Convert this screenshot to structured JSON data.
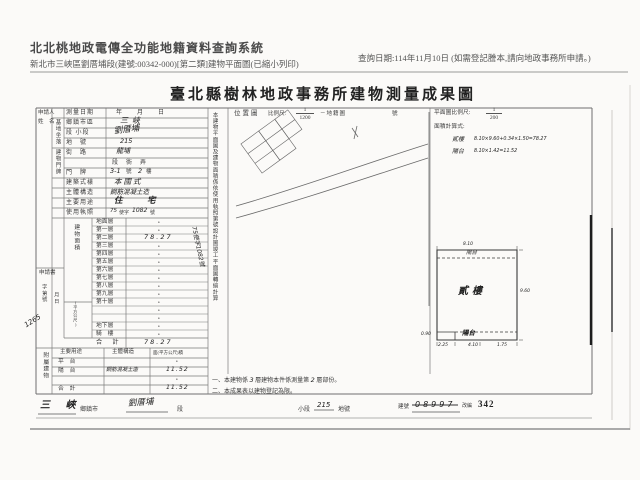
{
  "header": {
    "system_title": "北北桃地政電傳全功能地籍資料查詢系統",
    "subtitle": "新北市三峽區劉厝埔段(建號:00342-000)[第二類]建物平面圖(已縮小列印)",
    "query_date": "查詢日期:114年11月10日 (如需登記謄本,請向地政事務所申請。)"
  },
  "doc": {
    "title": "臺北縣樹林地政事務所建物測量成果圖",
    "form": {
      "applicant_line1": "申請人",
      "applicant_line2": "姓　名",
      "survey": {
        "label": "測量日期",
        "value": "年　　月　　日"
      },
      "site_group": "基地坐落",
      "site_rows": [
        {
          "label": "鄉鎮市區",
          "value": "三峽"
        },
        {
          "label": "段 小段",
          "value": "劉厝埔"
        },
        {
          "label": "地　號",
          "value": "215"
        }
      ],
      "addr_group": "建物門牌",
      "addr_street_label": "街　路",
      "addr_street_value": "龍埔",
      "addr_lane_print": "段　衖　弄",
      "addr_door_label": "門　牌",
      "addr_door": {
        "hand1": "3-1",
        "unit1": "號",
        "hand2": "2",
        "unit2": "樓"
      },
      "style": {
        "label": "建築式樣",
        "value": "本國式"
      },
      "structure": {
        "label": "主體構造",
        "value": "鋼筋混凝土造"
      },
      "usage": {
        "label": "主要用途",
        "value": "住　宅"
      },
      "license": {
        "label": "使用執照",
        "hand1": "75",
        "print1": "使字",
        "hand2": "1082",
        "print2": "號"
      },
      "area_group": "建物面積",
      "area_unit": "(平方公尺)",
      "floors": [
        {
          "label": "地面層",
          "value": "•"
        },
        {
          "label": "第一層",
          "value": "•"
        },
        {
          "label": "第二層",
          "value": ""
        },
        {
          "label": "第三層",
          "value": "•"
        },
        {
          "label": "第四層",
          "value": "•"
        },
        {
          "label": "第五層",
          "value": "•"
        },
        {
          "label": "第六層",
          "value": "•"
        },
        {
          "label": "第七層",
          "value": "•"
        },
        {
          "label": "第八層",
          "value": "•"
        },
        {
          "label": "第九層",
          "value": "•"
        },
        {
          "label": "第十層",
          "value": "•"
        },
        {
          "label": "",
          "value": "•"
        },
        {
          "label": "",
          "value": "•"
        },
        {
          "label": "地下層",
          "value": "•"
        },
        {
          "label": "騎　樓",
          "value": "•"
        }
      ],
      "floor2_area": "78.27",
      "total": {
        "label": "合　計",
        "value": "78.27"
      },
      "application": {
        "label": "申請書",
        "col1": "字第號",
        "col2": "月日",
        "hand": "1265"
      },
      "attached_group": "附屬建物",
      "attached_header": [
        "主要用途",
        "主體構造",
        "面(平方公尺)積"
      ],
      "attached_rows": {
        "r1": {
          "c1": "平　台",
          "c3": "•"
        },
        "r2": {
          "c1": "陽　台",
          "c2": "鋼筋混凝土造",
          "c3": "11.52"
        },
        "r3": {
          "c3": "•"
        },
        "r4": {
          "c1": "合　計",
          "c3": "11.52"
        }
      },
      "vertical_note": "本建物平面圖及建物面積係依使用執照第號設計圖竣工平面圖轉繪計算",
      "vertical_hand": "75使字1082號"
    },
    "map": {
      "title": "位置圖",
      "scale_label": "比例尺:",
      "scale_num": "1",
      "scale_den": "1200",
      "ref_label": "－地籍圖",
      "ref_unit": "號"
    },
    "plan": {
      "scale_label": "平面圖比例尺:",
      "scale_num": "1",
      "scale_den": "200",
      "calc_label": "面積計算式:",
      "calc_row1_name": "貳樓",
      "calc_row1_formula": "8.10×9.60+0.34×1.50=78.27",
      "calc_row2_name": "陽台",
      "calc_row2_formula": "8.10×1.42=11.52",
      "drawing": {
        "room": "貳樓",
        "balcony_top": "陽台",
        "balcony_bottom": "陽台",
        "dim_top": "8.10",
        "dim_right": "9.60",
        "dim_bottom_1": "2.25",
        "dim_bottom_2": "4.10",
        "dim_bottom_3": "1.75",
        "dim_left": "0.90"
      }
    },
    "notes": {
      "n1_pre": "一、本建物係",
      "n1_hand1": "3",
      "n1_mid": "層建物本件係測量第",
      "n1_hand2": "2",
      "n1_suf": "層部份。",
      "n2": "二、本成果表以建物登記為限。"
    },
    "bottom": {
      "township_hand": "三 峽",
      "township_label": "鄉鎮市",
      "section_hand": "劉厝埔",
      "section_label": "段",
      "subsection_label": "小段",
      "parcel_hand": "215",
      "parcel_label": "地號",
      "bldg_label": "建號",
      "bldg_old": "08997",
      "bldg_stamp": "改編",
      "bldg_new": "342"
    }
  }
}
